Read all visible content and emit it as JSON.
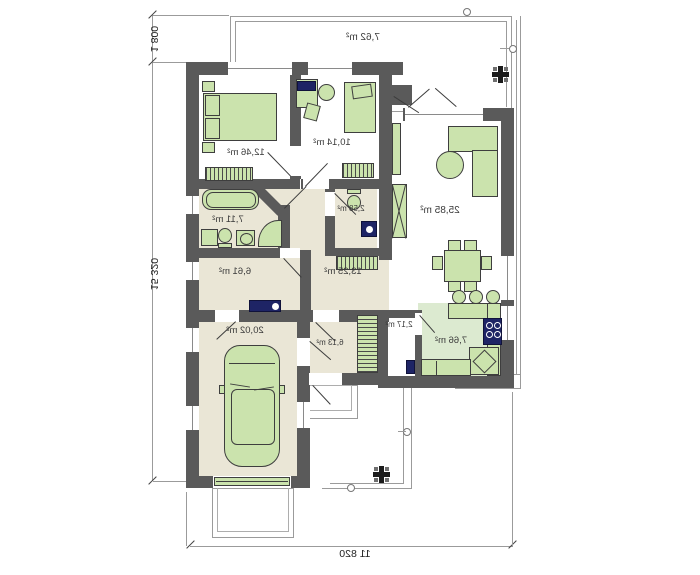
{
  "plan_title": "mirrored single-storey house floor plan",
  "dimensions": {
    "bottom_width": "11 820",
    "left_height": "15 320",
    "top_left_terrace_depth": "1 800"
  },
  "rooms": [
    {
      "name": "bedroom",
      "area": "12,46 m²"
    },
    {
      "name": "room",
      "area": "10,14 m²"
    },
    {
      "name": "bathroom",
      "area": "7,11 m²"
    },
    {
      "name": "wc",
      "area": "2,58 m²"
    },
    {
      "name": "hall",
      "area": "13,25 m²"
    },
    {
      "name": "utility-room",
      "area": "6,61 m²"
    },
    {
      "name": "garage",
      "area": "20,02 m²"
    },
    {
      "name": "entry-hall",
      "area": "6,13 m²"
    },
    {
      "name": "pantry",
      "area": "2,17 m²"
    },
    {
      "name": "kitchen",
      "area": "7,66 m²"
    },
    {
      "name": "living-room",
      "area": "25,85 m²"
    },
    {
      "name": "terrace",
      "area": "7,62 m²"
    }
  ],
  "colors": {
    "wall": "#5a5a5a",
    "floor_beige": "#eae6d6",
    "floor_kitchen": "#dcead0",
    "furniture_green": "#cbe3ad",
    "fixture_navy": "#1e2465",
    "outline_gray": "#9b9b9b"
  },
  "icons": [
    "drain-cross-icon",
    "downspout-icon"
  ]
}
